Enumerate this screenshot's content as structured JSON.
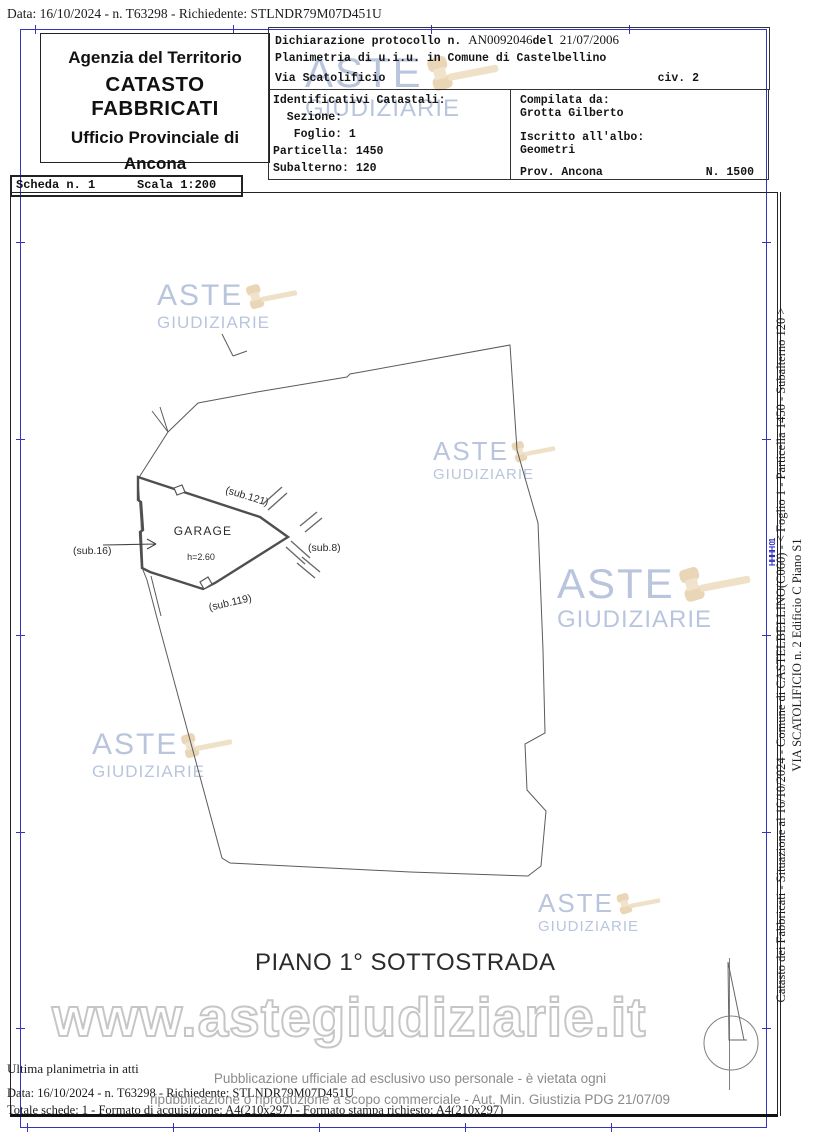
{
  "page": {
    "top_line": "Data: 16/10/2024 - n. T63298 - Richiedente: STLNDR79M07D451U"
  },
  "header": {
    "agency": "Agenzia del Territorio",
    "registry": "CATASTO FABBRICATI",
    "office": "Ufficio Provinciale di",
    "city": "Ancona"
  },
  "scheda": {
    "label": "Scheda n. 1",
    "scale": "Scala 1:200"
  },
  "declaration": {
    "line1_prefix": "Dichiarazione protocollo n. ",
    "protocol": "AN0092046",
    "del_word": "del",
    "date": "21/07/2006",
    "line2": "Planimetria di u.i.u. in Comune di Castelbellino",
    "street": "Via Scatolificio",
    "civic": "civ. 2"
  },
  "identifiers": {
    "title": "Identificativi Catastali:",
    "sezione": "  Sezione:",
    "foglio": "   Foglio: 1",
    "particella": "Particella: 1450",
    "subalterno": "Subalterno: 120"
  },
  "compiler": {
    "label": "Compilata da:",
    "name": "Grotta Gilberto",
    "register_label": "Iscritto all'albo:",
    "register": "Geometri",
    "province": "Prov. Ancona",
    "number": "N. 1500"
  },
  "plan": {
    "labels": {
      "sub121": "(sub.121)",
      "sub119": "(sub.119)",
      "sub16": "(sub.16)",
      "sub8": "(sub.8)",
      "garage": "GARAGE",
      "height": "h=2.60"
    },
    "floor_title": "PIANO 1° SOTTOSTRADA"
  },
  "watermark": {
    "line1": "ASTE",
    "line2": "GIUDIZIARIE",
    "url": "www.astegiudiziarie.it",
    "brand_blue": "#adbbd8",
    "gavel_tan": "#e9d6b6"
  },
  "side_caption": {
    "line1": "Catasto dei Fabbricati - Situazione al 16/10/2024 - Comune di CASTELBELLINO(C060) - <  Foglio 1 - Particella  1450 - Subalterno 120 >",
    "line2": "VIA SCATOLIFICIO n. 2  Edificio C Piano S1"
  },
  "blue_stamp": "HHHH 01",
  "footer": {
    "ultima": "Ultima planimetria in atti",
    "data_line": "Data: 16/10/2024 - n. T63298 - Richiedente: STLNDR79M07D451U",
    "totale": "Totale schede: 1 - Formato di acquisizione: A4(210x297) - Formato stampa richiesto: A4(210x297)",
    "pub1": "Pubblicazione ufficiale ad esclusivo uso personale - è vietata ogni",
    "pub2": "ripubblicazione o riproduzione a scopo commerciale - Aut. Min. Giustizia PDG 21/07/09"
  }
}
